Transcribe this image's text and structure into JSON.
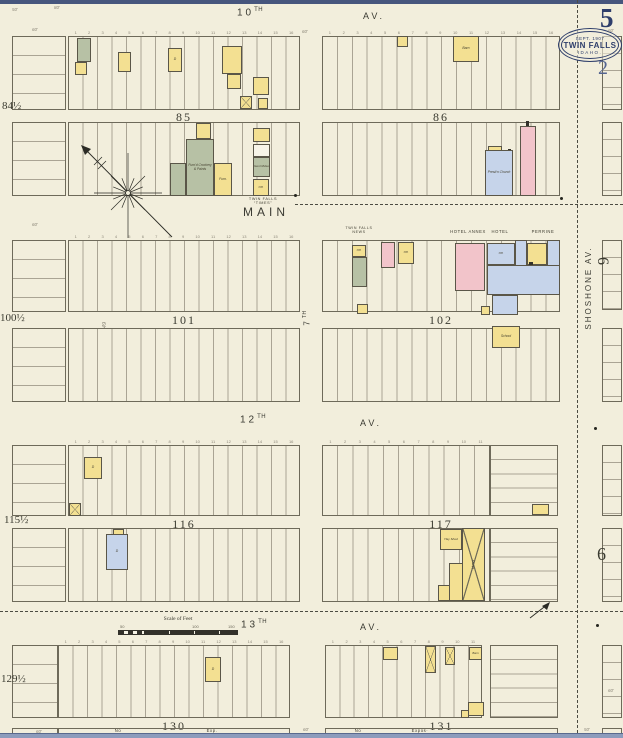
{
  "corner": {
    "sheet_number": "5",
    "page_number": "2"
  },
  "stamp": {
    "date": "SEPT. 1907",
    "city": "TWIN FALLS",
    "state": "IDAHO."
  },
  "streets": {
    "tenth_num": "10",
    "tenth_suf": "TH",
    "tenth_av": "AV.",
    "main": "MAIN",
    "seventh_num": "7",
    "seventh_suf": "TH",
    "twelfth_num": "12",
    "twelfth_suf": "TH",
    "twelfth_av": "AV.",
    "thirteenth_num": "13",
    "thirteenth_suf": "TH",
    "thirteenth_av": "AV.",
    "shoshone": "SHOSHONE AV."
  },
  "blocks": {
    "b85": "85",
    "b86": "86",
    "b101": "101",
    "b102": "102",
    "b116": "116",
    "b117": "117",
    "b130": "130",
    "b131": "131"
  },
  "partials": {
    "left84": "84½",
    "left100": "100½",
    "left115": "115½",
    "left129": "129½",
    "dim49": "49",
    "right6_upper": "6",
    "right6_lower": "6"
  },
  "scalebar": {
    "title": "Scale of Feet",
    "l50": "50",
    "l100": "100",
    "l150": "150"
  },
  "buildings": [
    {
      "x": 77,
      "y": 38,
      "w": 14,
      "h": 24,
      "c": "g"
    },
    {
      "x": 75,
      "y": 62,
      "w": 12,
      "h": 13,
      "c": "y"
    },
    {
      "x": 118,
      "y": 52,
      "w": 13,
      "h": 20,
      "c": "y"
    },
    {
      "x": 168,
      "y": 48,
      "w": 14,
      "h": 24,
      "c": "y",
      "t": "D",
      "ts": 3.4
    },
    {
      "x": 222,
      "y": 46,
      "w": 20,
      "h": 28,
      "c": "y"
    },
    {
      "x": 227,
      "y": 74,
      "w": 14,
      "h": 15,
      "c": "y"
    },
    {
      "x": 240,
      "y": 96,
      "w": 12,
      "h": 13,
      "c": "y",
      "cross": true
    },
    {
      "x": 253,
      "y": 77,
      "w": 16,
      "h": 18,
      "c": "y"
    },
    {
      "x": 258,
      "y": 98,
      "w": 10,
      "h": 11,
      "c": "y"
    },
    {
      "x": 196,
      "y": 123,
      "w": 15,
      "h": 16,
      "c": "y"
    },
    {
      "x": 186,
      "y": 139,
      "w": 28,
      "h": 57,
      "c": "g",
      "t": "Furn'd Crockery & Paints",
      "ts": 3.3
    },
    {
      "x": 170,
      "y": 163,
      "w": 16,
      "h": 33,
      "c": "g"
    },
    {
      "x": 214,
      "y": 163,
      "w": 18,
      "h": 33,
      "c": "y",
      "t": "Furn.",
      "ts": 3.3
    },
    {
      "x": 253,
      "y": 128,
      "w": 17,
      "h": 14,
      "c": "y"
    },
    {
      "x": 253,
      "y": 144,
      "w": 17,
      "h": 13,
      "c": "w"
    },
    {
      "x": 253,
      "y": 157,
      "w": 17,
      "h": 20,
      "c": "g",
      "t": "Genl Mdse",
      "ts": 3.1
    },
    {
      "x": 253,
      "y": 179,
      "w": 16,
      "h": 17,
      "c": "y",
      "t": "Off.",
      "ts": 3.1
    },
    {
      "x": 397,
      "y": 36,
      "w": 11,
      "h": 11,
      "c": "y"
    },
    {
      "x": 453,
      "y": 36,
      "w": 26,
      "h": 26,
      "c": "y",
      "t": "Barn",
      "ts": 3.4
    },
    {
      "x": 488,
      "y": 146,
      "w": 14,
      "h": 5,
      "c": "y"
    },
    {
      "x": 508,
      "y": 149,
      "w": 3,
      "h": 4,
      "c": "k"
    },
    {
      "x": 485,
      "y": 150,
      "w": 28,
      "h": 46,
      "c": "bl",
      "t": "Presb'n Church",
      "ts": 3.3
    },
    {
      "x": 526,
      "y": 121,
      "w": 3,
      "h": 6,
      "c": "k"
    },
    {
      "x": 520,
      "y": 126,
      "w": 16,
      "h": 70,
      "c": "p"
    },
    {
      "x": 352,
      "y": 245,
      "w": 14,
      "h": 12,
      "c": "y",
      "t": "Off.",
      "ts": 3
    },
    {
      "x": 352,
      "y": 257,
      "w": 15,
      "h": 30,
      "c": "g"
    },
    {
      "x": 357,
      "y": 304,
      "w": 11,
      "h": 10,
      "c": "y"
    },
    {
      "x": 381,
      "y": 242,
      "w": 14,
      "h": 26,
      "c": "p"
    },
    {
      "x": 398,
      "y": 242,
      "w": 16,
      "h": 22,
      "c": "y",
      "t": "Off.",
      "ts": 3
    },
    {
      "x": 455,
      "y": 243,
      "w": 30,
      "h": 48,
      "c": "p"
    },
    {
      "x": 487,
      "y": 243,
      "w": 28,
      "h": 22,
      "c": "bl",
      "t": "Off.",
      "ts": 3
    },
    {
      "x": 515,
      "y": 240,
      "w": 12,
      "h": 34,
      "c": "bl"
    },
    {
      "x": 547,
      "y": 240,
      "w": 13,
      "h": 34,
      "c": "bl"
    },
    {
      "x": 527,
      "y": 243,
      "w": 20,
      "h": 22,
      "c": "y"
    },
    {
      "x": 487,
      "y": 265,
      "w": 73,
      "h": 30,
      "c": "bl"
    },
    {
      "x": 529,
      "y": 262,
      "w": 4,
      "h": 3,
      "c": "k"
    },
    {
      "x": 492,
      "y": 295,
      "w": 26,
      "h": 20,
      "c": "bl"
    },
    {
      "x": 481,
      "y": 306,
      "w": 9,
      "h": 9,
      "c": "y"
    },
    {
      "x": 492,
      "y": 326,
      "w": 28,
      "h": 22,
      "c": "y",
      "t": "School",
      "ts": 3.4
    },
    {
      "x": 84,
      "y": 457,
      "w": 18,
      "h": 22,
      "c": "y",
      "t": "D",
      "ts": 3.4
    },
    {
      "x": 69,
      "y": 503,
      "w": 12,
      "h": 13,
      "c": "y",
      "cross": true
    },
    {
      "x": 113,
      "y": 529,
      "w": 11,
      "h": 6,
      "c": "y"
    },
    {
      "x": 106,
      "y": 534,
      "w": 22,
      "h": 36,
      "c": "bl",
      "t": "D",
      "ts": 3.4
    },
    {
      "x": 532,
      "y": 504,
      "w": 17,
      "h": 11,
      "c": "y"
    },
    {
      "x": 440,
      "y": 529,
      "w": 22,
      "h": 21,
      "c": "y",
      "t": "Hay Shed",
      "ts": 3.1
    },
    {
      "x": 462,
      "y": 528,
      "w": 23,
      "h": 73,
      "c": "y",
      "cross": true,
      "t": "Livery",
      "rot": -90,
      "ts": 3.6
    },
    {
      "x": 449,
      "y": 563,
      "w": 14,
      "h": 38,
      "c": "y"
    },
    {
      "x": 438,
      "y": 585,
      "w": 12,
      "h": 16,
      "c": "y"
    },
    {
      "x": 205,
      "y": 657,
      "w": 16,
      "h": 25,
      "c": "y",
      "t": "D",
      "ts": 3.4
    },
    {
      "x": 383,
      "y": 647,
      "w": 15,
      "h": 13,
      "c": "y"
    },
    {
      "x": 425,
      "y": 646,
      "w": 11,
      "h": 27,
      "c": "y",
      "cross": true
    },
    {
      "x": 445,
      "y": 647,
      "w": 10,
      "h": 18,
      "c": "y",
      "cross": true
    },
    {
      "x": 469,
      "y": 647,
      "w": 13,
      "h": 13,
      "c": "y",
      "t": "Barn",
      "ts": 3
    },
    {
      "x": 468,
      "y": 702,
      "w": 16,
      "h": 14,
      "c": "y"
    },
    {
      "x": 461,
      "y": 710,
      "w": 8,
      "h": 8,
      "c": "y"
    }
  ],
  "captions": [
    {
      "t": "TWIN FALLS\nNEWS",
      "x": 340,
      "y": 226,
      "w": 38,
      "s": 3.6
    },
    {
      "t": "HOTEL  ANNEX",
      "x": 444,
      "y": 230,
      "w": 48,
      "s": 4.2
    },
    {
      "t": "HOTEL",
      "x": 486,
      "y": 230,
      "w": 28,
      "s": 4.2
    },
    {
      "t": "PERRINE",
      "x": 524,
      "y": 230,
      "w": 38,
      "s": 4.2
    },
    {
      "t": "TWIN FALLS\n“TIMES”",
      "x": 238,
      "y": 197,
      "w": 50,
      "s": 3.8
    },
    {
      "t": "No",
      "x": 108,
      "y": 729,
      "w": 20,
      "s": 4.2
    },
    {
      "t": "Exp.",
      "x": 200,
      "y": 729,
      "w": 24,
      "s": 4.2
    },
    {
      "t": "No",
      "x": 348,
      "y": 729,
      "w": 20,
      "s": 4.2
    },
    {
      "t": "Expos·",
      "x": 404,
      "y": 729,
      "w": 32,
      "s": 4.2
    }
  ],
  "dims": [
    {
      "t": "50'",
      "x": 12,
      "y": 7
    },
    {
      "t": "80'",
      "x": 54,
      "y": 5
    },
    {
      "t": "60'",
      "x": 32,
      "y": 27
    },
    {
      "t": "60'",
      "x": 302,
      "y": 29
    },
    {
      "t": "60'",
      "x": 608,
      "y": 28
    },
    {
      "t": "60'",
      "x": 32,
      "y": 222
    },
    {
      "t": "60'",
      "x": 36,
      "y": 729
    },
    {
      "t": "60'",
      "x": 303,
      "y": 727
    },
    {
      "t": "50'",
      "x": 584,
      "y": 727
    },
    {
      "t": "60'",
      "x": 608,
      "y": 688
    }
  ],
  "markers": [
    {
      "x": 294,
      "y": 194
    },
    {
      "x": 560,
      "y": 197
    },
    {
      "x": 594,
      "y": 427
    },
    {
      "x": 596,
      "y": 624
    }
  ]
}
